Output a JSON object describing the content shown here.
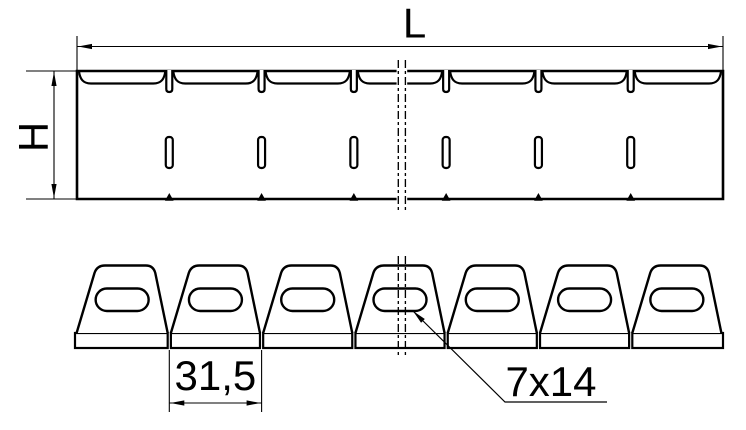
{
  "drawing": {
    "background_color": "#ffffff",
    "line_color": "#000000",
    "labels": {
      "length": "L",
      "height": "H",
      "tab_pitch": "31,5",
      "hole_size": "7x14"
    },
    "structure": {
      "segment_count": 7,
      "divider_count": 6
    }
  }
}
